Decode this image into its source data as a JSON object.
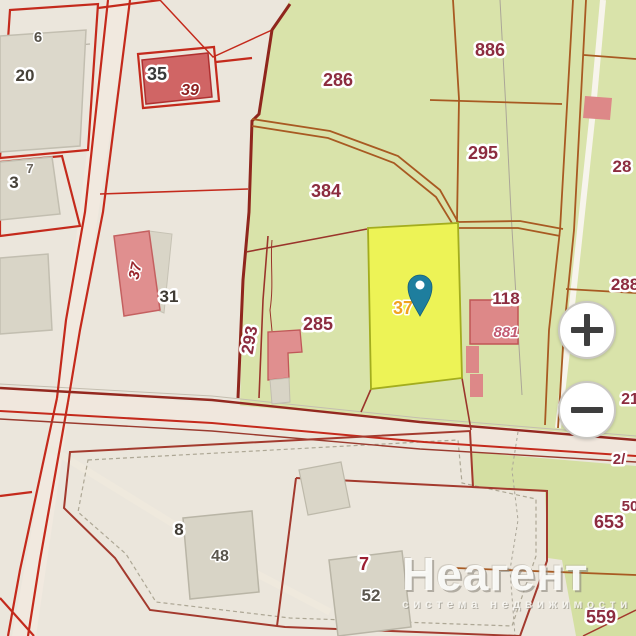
{
  "map": {
    "labels": [
      {
        "text": "6"
      },
      {
        "text": "20"
      },
      {
        "text": "35"
      },
      {
        "text": "39"
      },
      {
        "text": "7"
      },
      {
        "text": "3"
      },
      {
        "text": "37"
      },
      {
        "text": "31"
      },
      {
        "text": "286"
      },
      {
        "text": "886"
      },
      {
        "text": "295"
      },
      {
        "text": "384"
      },
      {
        "text": "285"
      },
      {
        "text": "293"
      },
      {
        "text": "37"
      },
      {
        "text": "118"
      },
      {
        "text": "881"
      },
      {
        "text": "28"
      },
      {
        "text": "288"
      },
      {
        "text": "21"
      },
      {
        "text": "2/"
      },
      {
        "text": "653"
      },
      {
        "text": "50"
      },
      {
        "text": "559"
      },
      {
        "text": "8"
      },
      {
        "text": "48"
      },
      {
        "text": "7"
      },
      {
        "text": "52"
      }
    ],
    "icons": {
      "pin": "location-pin-icon",
      "zoom_in": "plus-icon",
      "zoom_out": "minus-icon"
    },
    "colors": {
      "selected_parcel_fill": "#EDF356",
      "pin": "#1E7E9E",
      "parcel_line_red": "#C42A1C",
      "field_green": "#D9E3AA",
      "label_maroon": "#8C2C3F"
    }
  },
  "controls": {
    "zoom_in_glyph": "+",
    "zoom_out_glyph": "−"
  },
  "watermark": {
    "title": "Неагент",
    "subtitle": "система недвижимости"
  }
}
